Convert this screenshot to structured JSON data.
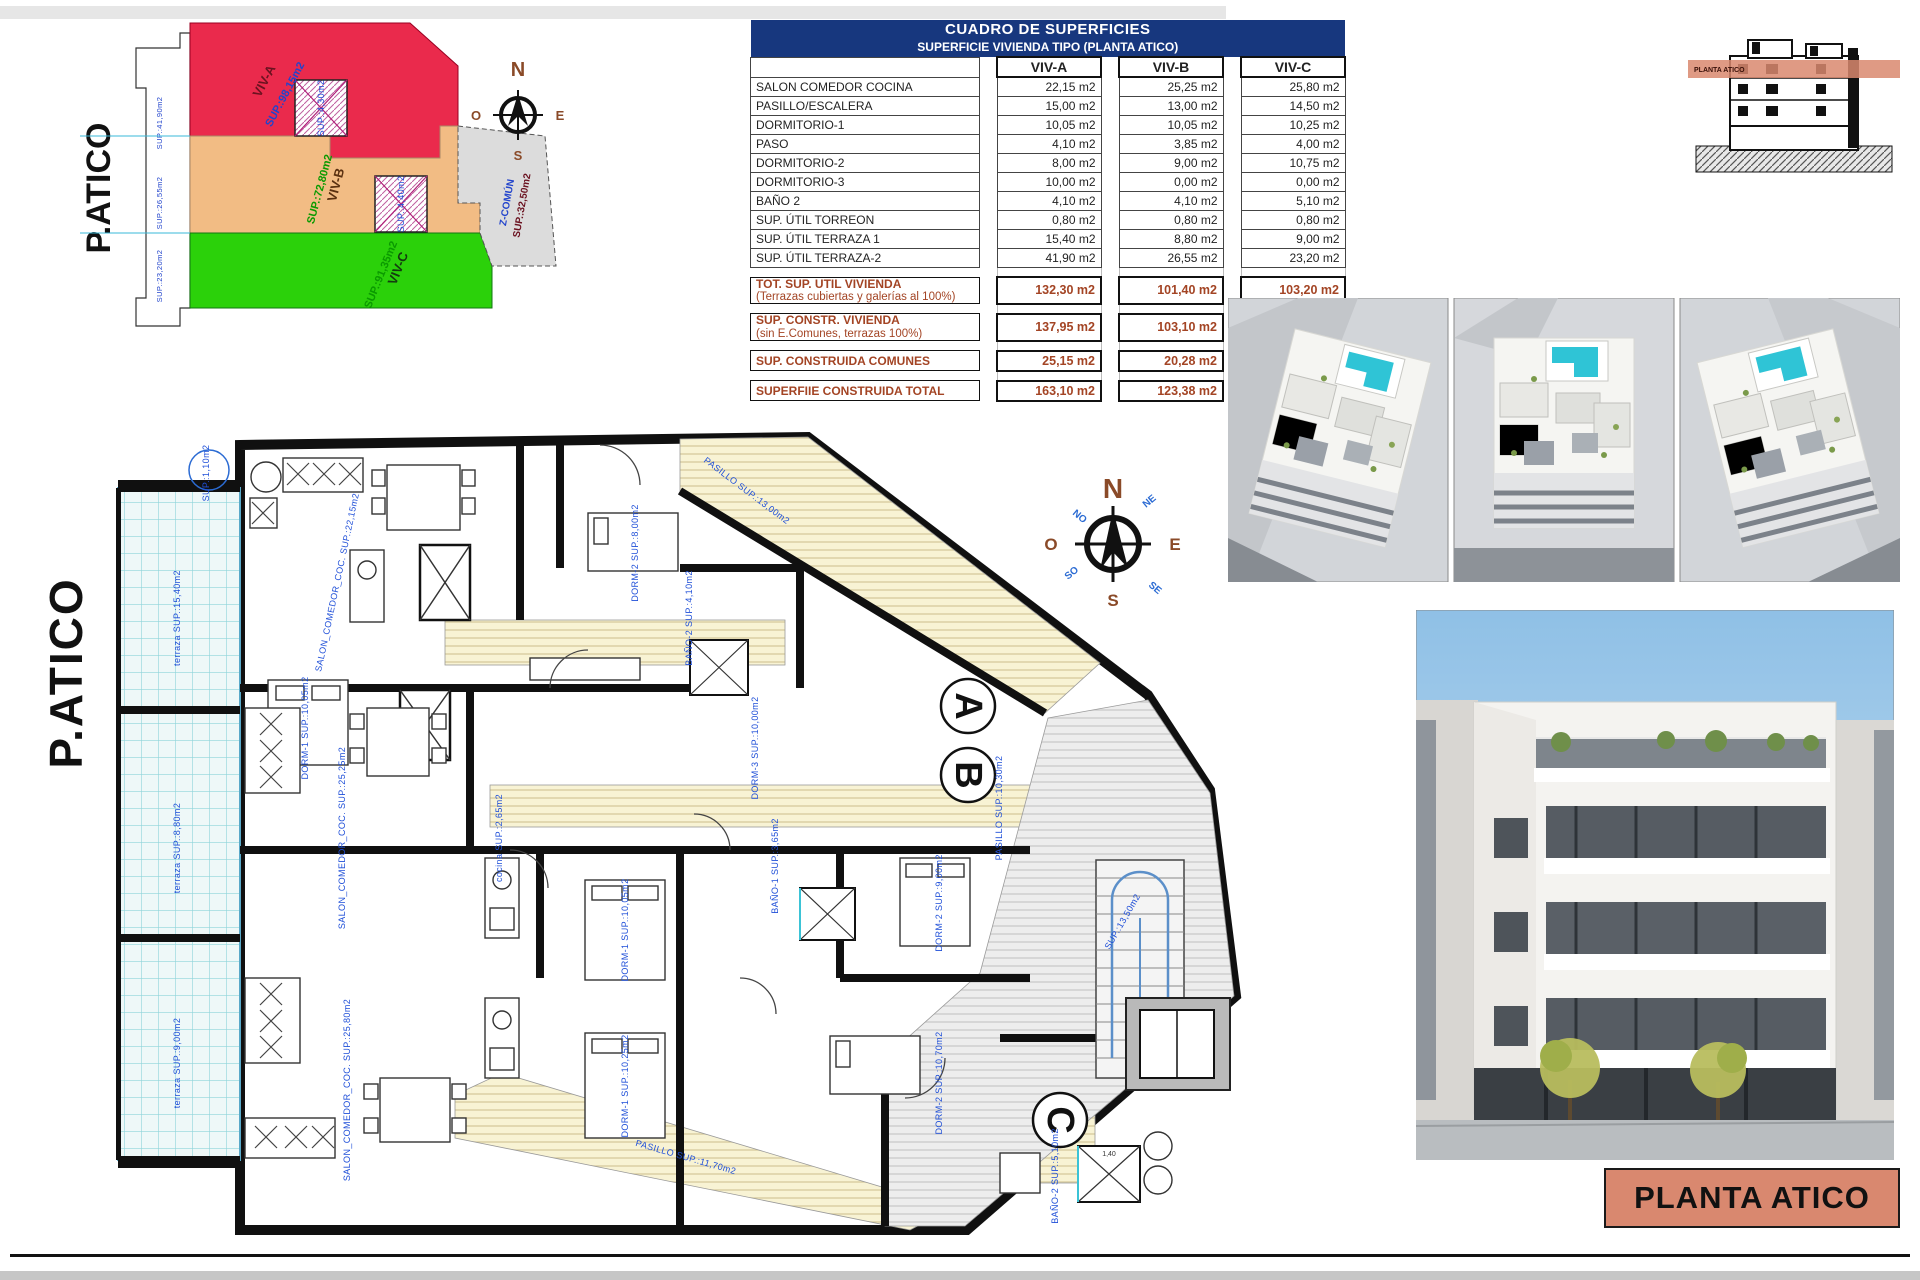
{
  "sheet": {
    "bottom_title": "PLANTA ATICO"
  },
  "site_plan": {
    "big_label": "P.ATICO",
    "zones": [
      {
        "name": "VIV-A",
        "sup": "SUP.:98,15m2"
      },
      {
        "name": "VIV-B",
        "sup": "SUP.:72,80m2"
      },
      {
        "name": "VIV-C",
        "sup": "SUP.:91,35m2"
      },
      {
        "name": "Z-COMÚN",
        "sup": "SUP.:32,50m2"
      }
    ],
    "edge_labels": [
      "SUP.:41,90m2",
      "SUP.:26,55m2",
      "SUP.:23,20m2"
    ],
    "core_labels": [
      "SUP.:4,30m2",
      "SUP.:4,40m2"
    ]
  },
  "compass": {
    "n": "N",
    "s": "S",
    "e": "E",
    "o": "O",
    "ne": "NE",
    "no": "NO",
    "se": "SE",
    "so": "SO"
  },
  "areas_table": {
    "title": "CUADRO DE SUPERFICIES",
    "subtitle": "SUPERFICIE VIVIENDA TIPO  (PLANTA ATICO)",
    "columns": [
      "VIV-A",
      "VIV-B",
      "VIV-C"
    ],
    "rows": [
      {
        "label": "SALON COMEDOR COCINA",
        "values": [
          "22,15 m2",
          "25,25 m2",
          "25,80 m2"
        ]
      },
      {
        "label": "PASILLO/ESCALERA",
        "values": [
          "15,00 m2",
          "13,00 m2",
          "14,50 m2"
        ]
      },
      {
        "label": "DORMITORIO-1",
        "values": [
          "10,05 m2",
          "10,05 m2",
          "10,25 m2"
        ]
      },
      {
        "label": "PASO",
        "values": [
          "4,10 m2",
          "3,85 m2",
          "4,00 m2"
        ]
      },
      {
        "label": "DORMITORIO-2",
        "values": [
          "8,00 m2",
          "9,00 m2",
          "10,75 m2"
        ]
      },
      {
        "label": "DORMITORIO-3",
        "values": [
          "10,00 m2",
          "0,00 m2",
          "0,00 m2"
        ]
      },
      {
        "label": "BAÑO 2",
        "values": [
          "4,10 m2",
          "4,10 m2",
          "5,10 m2"
        ]
      },
      {
        "label": "SUP. ÚTIL TORREON",
        "values": [
          "0,80 m2",
          "0,80 m2",
          "0,80 m2"
        ]
      },
      {
        "label": "SUP. ÚTIL TERRAZA 1",
        "values": [
          "15,40 m2",
          "8,80 m2",
          "9,00 m2"
        ]
      },
      {
        "label": "SUP. ÚTIL TERRAZA-2",
        "values": [
          "41,90 m2",
          "26,55 m2",
          "23,20 m2"
        ]
      }
    ],
    "summary_rows": [
      {
        "label": "TOT. SUP. UTIL VIVIENDA",
        "label2": "(Terrazas cubiertas y galerías al 100%)",
        "values": [
          "132,30 m2",
          "101,40 m2",
          "103,20 m2"
        ]
      },
      {
        "label": "SUP. CONSTR. VIVIENDA",
        "label2": "(sin E.Comunes, terrazas 100%)",
        "values": [
          "137,95 m2",
          "103,10 m2",
          "108,75 m2"
        ]
      },
      {
        "label": "SUP. CONSTRUIDA COMUNES",
        "label2": "",
        "values": [
          "25,15 m2",
          "20,28 m2",
          "21,10 m2"
        ]
      },
      {
        "label": "SUPERFIIE CONSTRUIDA TOTAL",
        "label2": "",
        "values": [
          "163,10 m2",
          "123,38 m2",
          "129,85 m2"
        ]
      }
    ]
  },
  "section_diagram": {
    "band_label": "PLANTA ATICO"
  },
  "floor_plan": {
    "big_label": "P.ATICO",
    "unit_markers": [
      "A",
      "B",
      "C"
    ],
    "shower_dim": "1,40",
    "labels": [
      "SUP.:1,10m2",
      "terraza SUP.:15,40m2",
      "terraza SUP.:8,80m2",
      "terraza SUP.:9,00m2",
      "SALON_COMEDOR_COC. SUP.:22,15m2",
      "PASILLO SUP.:13,00m2",
      "DORM-1 SUP.:10,05m2",
      "DORM-2 SUP.:8,00m2",
      "BAÑO-2 SUP.:4,10m2",
      "DORM-3 SUP.:10,00m2",
      "SALON_COMEDOR_COC. SUP.:25,25m2",
      "DORM-1 SUP.:10,05m2",
      "DORM-2 SUP.:9,00m2",
      "BAÑO-1 SUP.:3,65m2",
      "PASILLO SUP.:10,30m2",
      "SALON_COMEDOR_COC. SUP.:25,80m2",
      "DORM-1 SUP.:10,25m2",
      "DORM-2 SUP.:10,70m2",
      "BAÑO-2 SUP.:5,10m2",
      "PASILLO SUP.:11,70m2",
      "SUP.:13,50m2",
      "cocina SUP.:2,65m2"
    ]
  }
}
